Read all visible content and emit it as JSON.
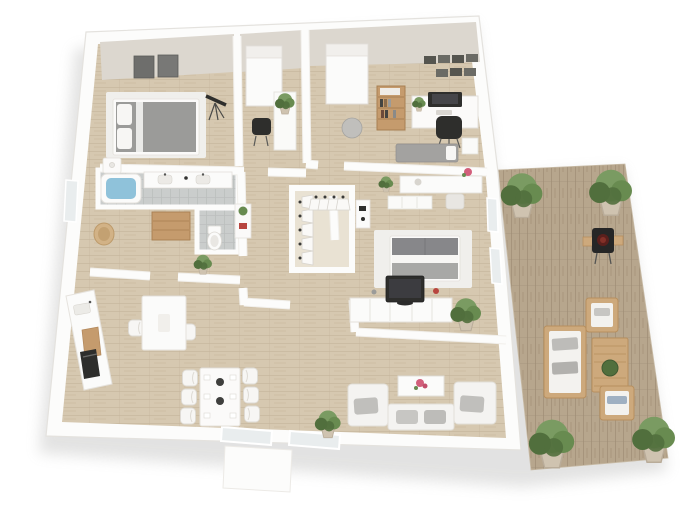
{
  "canvas": {
    "width": 700,
    "height": 525,
    "background": "#ffffff"
  },
  "scene": {
    "kind": "3d-floor-plan-render",
    "view": "isometric top-down apartment plan with wooden terrace on the right",
    "rooms": [
      {
        "id": "bedroom-1",
        "name": "bedroom top-left",
        "furniture": [
          "gray double bed with white pillows",
          "nightstand with lamp",
          "two dark wall pictures",
          "telescope"
        ]
      },
      {
        "id": "study-nook",
        "name": "study nook",
        "furniture": [
          "window with roller blind",
          "black desk chair",
          "white cabinet with plant"
        ]
      },
      {
        "id": "office",
        "name": "home office top-right",
        "furniture": [
          "window with roller blind",
          "wooden bookshelf",
          "white desk with monitor",
          "black office chair",
          "gray pouf",
          "gray daybed",
          "wall picture frames"
        ]
      },
      {
        "id": "bathroom",
        "name": "bathroom",
        "furniture": [
          "bathtub with water",
          "double vanity"
        ]
      },
      {
        "id": "wc",
        "name": "toilet room",
        "furniture": [
          "toilet"
        ]
      },
      {
        "id": "dressing",
        "name": "dressing room",
        "furniture": [
          "wooden dresser",
          "wicker basket",
          "plant stand",
          "white shelf with plant and red box"
        ]
      },
      {
        "id": "closet",
        "name": "walk-in closet",
        "furniture": [
          "hanging rail with white garments (vertical)",
          "hanging rail with white garments (horizontal)"
        ]
      },
      {
        "id": "master-bedroom",
        "name": "master bedroom",
        "furniture": [
          "gray bed with white stripe on white rug",
          "vanity desk with stool and red flowers",
          "white sideboard",
          "TV lowboard with flat TV",
          "potted plants"
        ]
      },
      {
        "id": "kitchen",
        "name": "kitchen",
        "furniture": [
          "white counter with sink, cutting board and black oven",
          "white breakfast table with two chairs"
        ]
      },
      {
        "id": "dining",
        "name": "dining area",
        "furniture": [
          "white table",
          "six white chairs",
          "two dark centerpieces",
          "place settings"
        ]
      },
      {
        "id": "living",
        "name": "living room",
        "furniture": [
          "white sofa with two armchairs and gray cushions",
          "white coffee table with pink flowers",
          "potted plant at window"
        ]
      },
      {
        "id": "deck",
        "name": "wooden terrace",
        "furniture": [
          "four large potted plants",
          "charcoal grill with wooden side shelves",
          "outdoor sofa with white cushions",
          "slatted wooden coffee table with green bowl",
          "two outdoor armchairs"
        ]
      }
    ]
  },
  "colors": {
    "wall": "#fcfcfb",
    "wall_edge": "#e4e2de",
    "wall_face": "#dcd7cf",
    "floor_wood": "#d6c8b0",
    "floor_seam": "#c2b297",
    "closet_floor": "#e9e2d3",
    "deck_wood": "#b7a68d",
    "deck_seam": "#9d8c73",
    "tile": "#cacdcc",
    "tile_line": "#bcbfbe",
    "rug": "#f0efec",
    "bed_gray": "#9b9b99",
    "bed_dark": "#87878a",
    "white_fabric": "#f7f6f4",
    "water": "#8fc2da",
    "plant_light": "#7a9b62",
    "plant_mid": "#688b50",
    "plant_dark": "#516f3d",
    "pot": "#cfc3b0",
    "wood_furniture": "#c59b6d",
    "wood_furniture_dark": "#a87f52",
    "outdoor_wood": "#cda97c",
    "outdoor_wood_dark": "#b78f5e",
    "charcoal": "#2e2e2c",
    "cushion": "#c0bfbc",
    "flower_pink": "#d25f7b",
    "flower_red": "#b8453f",
    "white_furniture": "#fbfaf9",
    "furniture_edge": "#e3e0da",
    "glass": "#e9edee",
    "shadow": "#9a9a98"
  }
}
